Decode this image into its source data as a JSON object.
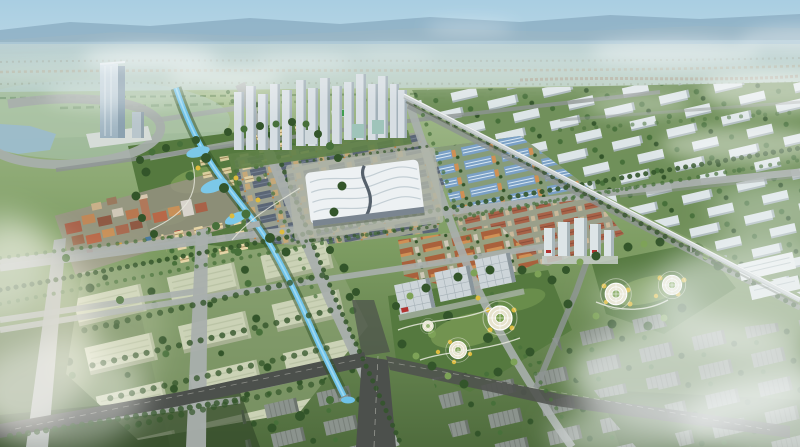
{
  "meta": {
    "title": "Aerial master-plan rendering of a new urban district",
    "description": "Bird's-eye architectural rendering: glass landmark tower, white residential tower cluster, wave-roof convention hall, trade-market blocks, blue-roof industrial sheds, warehouse grid, canal, landscaped parks with circular gardens, elevated rail viaduct, rows of white slab buildings, drifting clouds and mist",
    "visible_text": "none"
  },
  "palette": {
    "sky-top": "#a9cee2",
    "sky-low": "#cfe2e8",
    "ridge": "#86a8bd",
    "plain-top": "#bdd2d4",
    "plain-low": "#b3c8b4",
    "ground-far": "#a3bb8d",
    "ground-mid": "#7d9c62",
    "ground-near": "#4f6c3d",
    "forest": "#33552a",
    "tree": "#47703a",
    "tree-light": "#7da257",
    "tree-yellow": "#ddbb3e",
    "road-light": "#a9afad",
    "road-mid": "#8d9492",
    "asphalt": "#4c504c",
    "water": "#6fc2e8",
    "water-light": "#aadff2",
    "lake": "#9cbccb",
    "warehouse": "#cbd2b6",
    "warehouse-shade": "#a7b192",
    "slab-white": "#dde5e7",
    "slab-shade": "#a9b6ba",
    "slab-gray": "#8b938d",
    "slab-gray-dark": "#6c746d",
    "tower-glass": "#b7ccd7",
    "tower-shade": "#8ca2b0",
    "market-roof": "#5b6676",
    "market-tan": "#c5a878",
    "shed-blue": "#7aa0c6",
    "shed-ridge": "#d8e6f0",
    "orange-wall": "#cf9055",
    "orange-roof": "#a9613c",
    "red-brown": "#a86248",
    "exhibition-roof": "#edf1f3",
    "exhibition-line": "#c3ced4",
    "exhibition-dark": "#56616c",
    "office-face": "#cdd5d9",
    "office-shade": "#8a969c",
    "park-green": "#55793f",
    "park-light": "#8fae62",
    "path-white": "#e9eade",
    "circle-fill": "#e7e3cd",
    "viaduct": "#ccd2d3",
    "mist": "#f4f8f8",
    "glow": "#fdf9ee"
  },
  "scene": {
    "landmarks": [
      {
        "id": "landmark-tower",
        "label": "glass high-rise landmark tower with podium"
      },
      {
        "id": "highrise-cluster",
        "label": "cluster of white residential towers"
      },
      {
        "id": "exhibition-hall",
        "label": "convention hall with white wave-shaped roof"
      },
      {
        "id": "market-district",
        "label": "dense low-rise trade market blocks"
      },
      {
        "id": "shed-district",
        "label": "blue-roofed industrial sheds"
      },
      {
        "id": "warehouse-district",
        "label": "large pale warehouse blocks in tree grid"
      },
      {
        "id": "office-row",
        "label": "row of grid-facade office buildings"
      },
      {
        "id": "central-parks",
        "label": "landscaped parks with circular gardens and yellow trees"
      },
      {
        "id": "canal",
        "label": "blue canal winding through the park"
      },
      {
        "id": "viaduct",
        "label": "elevated rail viaduct crossing the district"
      },
      {
        "id": "ne-slab-housing",
        "label": "rows of white slab buildings in green fields"
      },
      {
        "id": "town-center",
        "label": "red-brown mixed-use town centre"
      },
      {
        "id": "clouds",
        "label": "drifting white clouds and mist"
      }
    ]
  }
}
